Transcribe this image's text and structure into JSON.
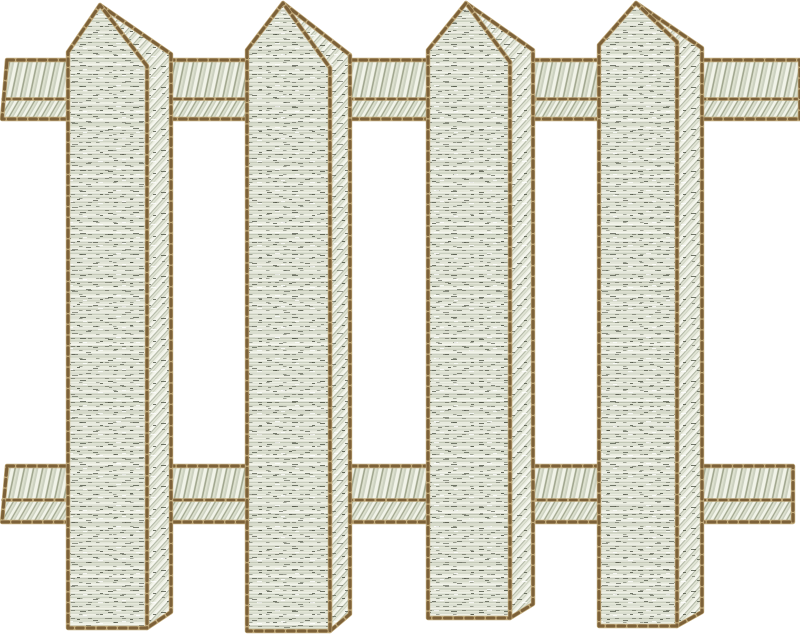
{
  "meta": {
    "alt": "Embroidered white picket fence design with four pointed pickets and two horizontal rails",
    "background": "#ffffff"
  },
  "palette": {
    "outline_dark": "#7c6139",
    "outline_light": "#c0a97a",
    "outline_mid": "#9a8153",
    "fill_base": "#e2e5d6",
    "fill_highlight": "#f5f6ee",
    "fill_highlight2": "#eceee2",
    "fill_mid": "#b2b8a6",
    "fill_mid2": "#ccd1c0",
    "speck_dark": "#454a3c",
    "rail_white": "#f1f3e8",
    "rail_shadow": "#a2a890",
    "rail_base": "#dde1cf"
  },
  "fence": {
    "canvas": {
      "width": 800,
      "height": 635
    },
    "rails": [
      {
        "id": "top-rail",
        "x1": 2,
        "x2": 800,
        "y_top": 60,
        "y_mid": 99,
        "y_bottom": 119,
        "left_cap_slant": 5
      },
      {
        "id": "bottom-rail",
        "x1": 2,
        "x2": 793,
        "y_top": 466,
        "y_mid": 500,
        "y_bottom": 522,
        "left_cap_slant": 5
      }
    ],
    "pickets": [
      {
        "id": "picket-1",
        "left": 68,
        "apex_x": 100,
        "front_right": 147,
        "side_right": 171,
        "apex_y": 5,
        "shoulder_y": 52,
        "ridge_y": 66,
        "side_top_y": 54,
        "bottom_y": 628,
        "side_bottom_y": 612
      },
      {
        "id": "picket-2",
        "left": 247,
        "apex_x": 283,
        "front_right": 330,
        "side_right": 350,
        "apex_y": 3,
        "shoulder_y": 50,
        "ridge_y": 68,
        "side_top_y": 55,
        "bottom_y": 631,
        "side_bottom_y": 614
      },
      {
        "id": "picket-3",
        "left": 428,
        "apex_x": 466,
        "front_right": 510,
        "side_right": 533,
        "apex_y": 3,
        "shoulder_y": 50,
        "ridge_y": 62,
        "side_top_y": 50,
        "bottom_y": 618,
        "side_bottom_y": 604
      },
      {
        "id": "picket-4",
        "left": 599,
        "apex_x": 636,
        "front_right": 677,
        "side_right": 702,
        "apex_y": 3,
        "shoulder_y": 45,
        "ridge_y": 42,
        "side_top_y": 48,
        "bottom_y": 626,
        "side_bottom_y": 612
      }
    ]
  }
}
